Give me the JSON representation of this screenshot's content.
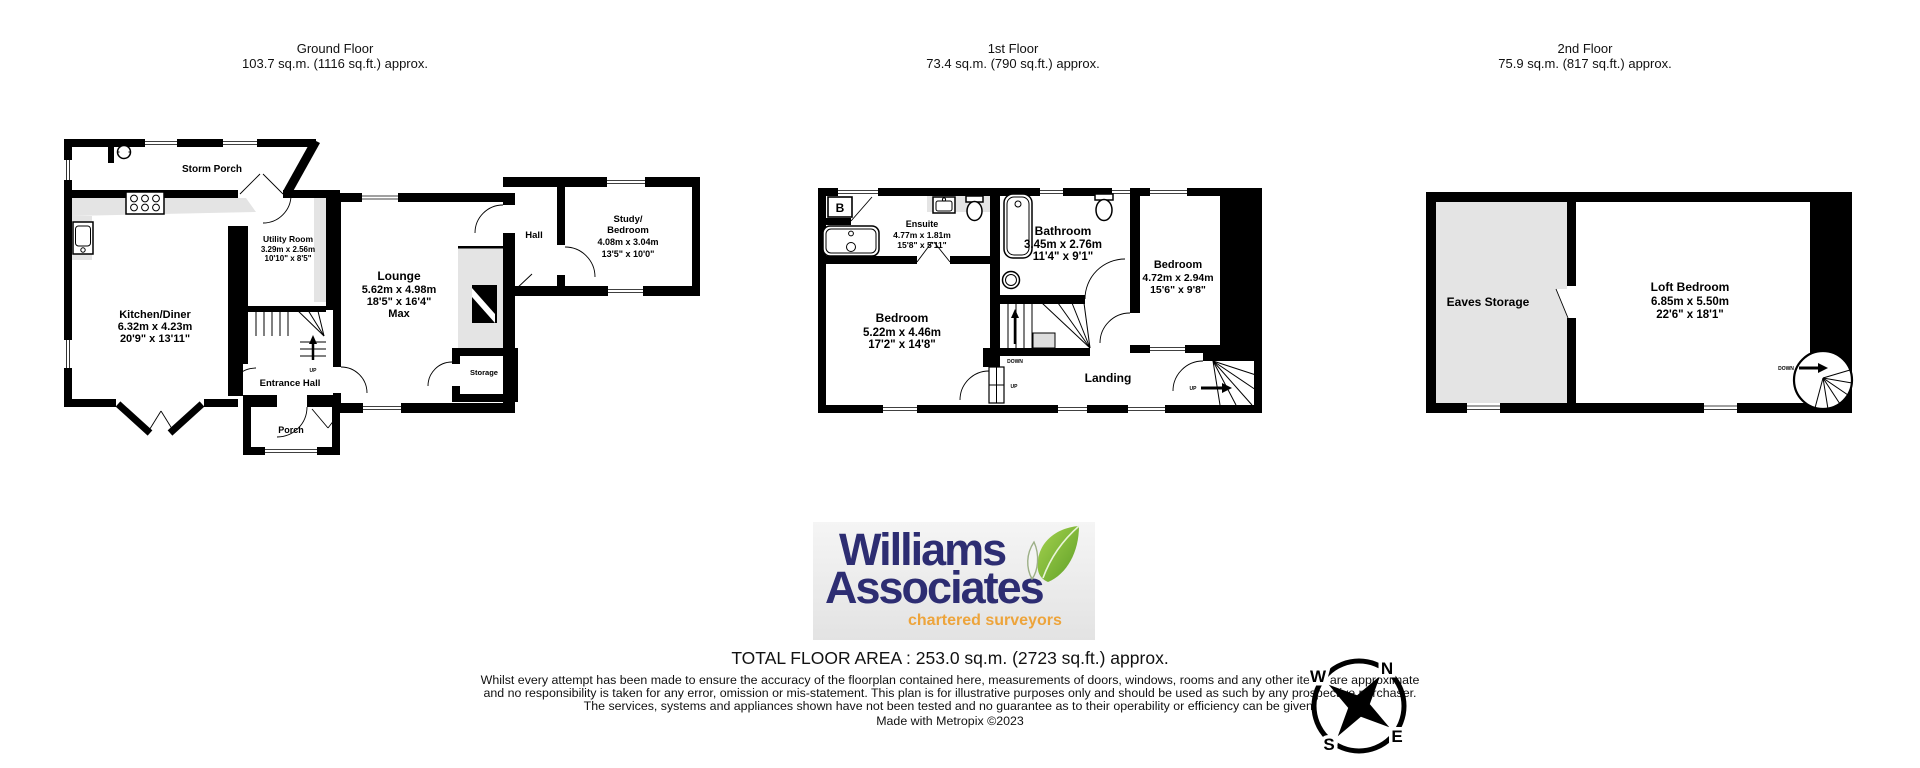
{
  "headers": {
    "ground": {
      "title": "Ground Floor",
      "area": "103.7 sq.m. (1116 sq.ft.) approx."
    },
    "first": {
      "title": "1st Floor",
      "area": "73.4 sq.m. (790 sq.ft.) approx."
    },
    "second": {
      "title": "2nd Floor",
      "area": "75.9 sq.m. (817 sq.ft.) approx."
    }
  },
  "ground": {
    "storm_porch": "Storm Porch",
    "kitchen": {
      "name": "Kitchen/Diner",
      "metric": "6.32m x 4.23m",
      "imperial": "20'9\" x 13'11\""
    },
    "utility": {
      "name": "Utility Room",
      "metric": "3.29m x 2.56m",
      "imperial": "10'10\" x 8'5\""
    },
    "lounge": {
      "name": "Lounge",
      "metric": "5.62m x 4.98m",
      "imperial": "18'5\" x 16'4\"",
      "suffix": "Max"
    },
    "entrance_hall": "Entrance Hall",
    "porch": "Porch",
    "hall": "Hall",
    "study": {
      "name1": "Study/",
      "name2": "Bedroom",
      "metric": "4.08m x 3.04m",
      "imperial": "13'5\" x 10'0\""
    },
    "storage": "Storage",
    "up_label": "UP"
  },
  "first": {
    "ensuite": {
      "name": "Ensuite",
      "metric": "4.77m x 1.81m",
      "imperial": "15'8\" x 5'11\""
    },
    "bathroom": {
      "name": "Bathroom",
      "metric": "3.45m x 2.76m",
      "imperial": "11'4\" x 9'1\""
    },
    "bedroom_front": {
      "name": "Bedroom",
      "metric": "5.22m x 4.46m",
      "imperial": "17'2\" x 14'8\""
    },
    "bedroom_rear": {
      "name": "Bedroom",
      "metric": "4.72m x 2.94m",
      "imperial": "15'6\" x 9'8\""
    },
    "landing": "Landing",
    "boiler_label": "B",
    "down_label": "DOWN",
    "up_label": "UP",
    "up_label2": "UP"
  },
  "second": {
    "eaves": "Eaves Storage",
    "loft": {
      "name": "Loft Bedroom",
      "metric": "6.85m x 5.50m",
      "imperial": "22'6\" x 18'1\""
    },
    "down_label": "DOWN"
  },
  "logo": {
    "name_line1": "Williams",
    "name_line2": "Associates",
    "tagline": "chartered surveyors"
  },
  "footer": {
    "total_area": "TOTAL FLOOR AREA : 253.0 sq.m. (2723 sq.ft.) approx.",
    "disclaimer": "Whilst every attempt has been made to ensure the accuracy of the floorplan contained here, measurements of doors, windows, rooms and any other items are approximate and no responsibility is taken for any error, omission or mis-statement. This plan is for illustrative purposes only and should be used as such by any prospective purchaser. The services, systems and appliances shown have not been tested and no guarantee as to their operability or efficiency can be given.",
    "credit": "Made with Metropix ©2023"
  },
  "compass": {
    "north": "N",
    "east": "E",
    "south": "S",
    "west": "W"
  },
  "colors": {
    "wall": "#000000",
    "room": "#ffffff",
    "shade": "#e4e4e4",
    "logo_navy": "#2d2d72",
    "logo_orange": "#eda43b",
    "leaf_green": "#76b832"
  }
}
